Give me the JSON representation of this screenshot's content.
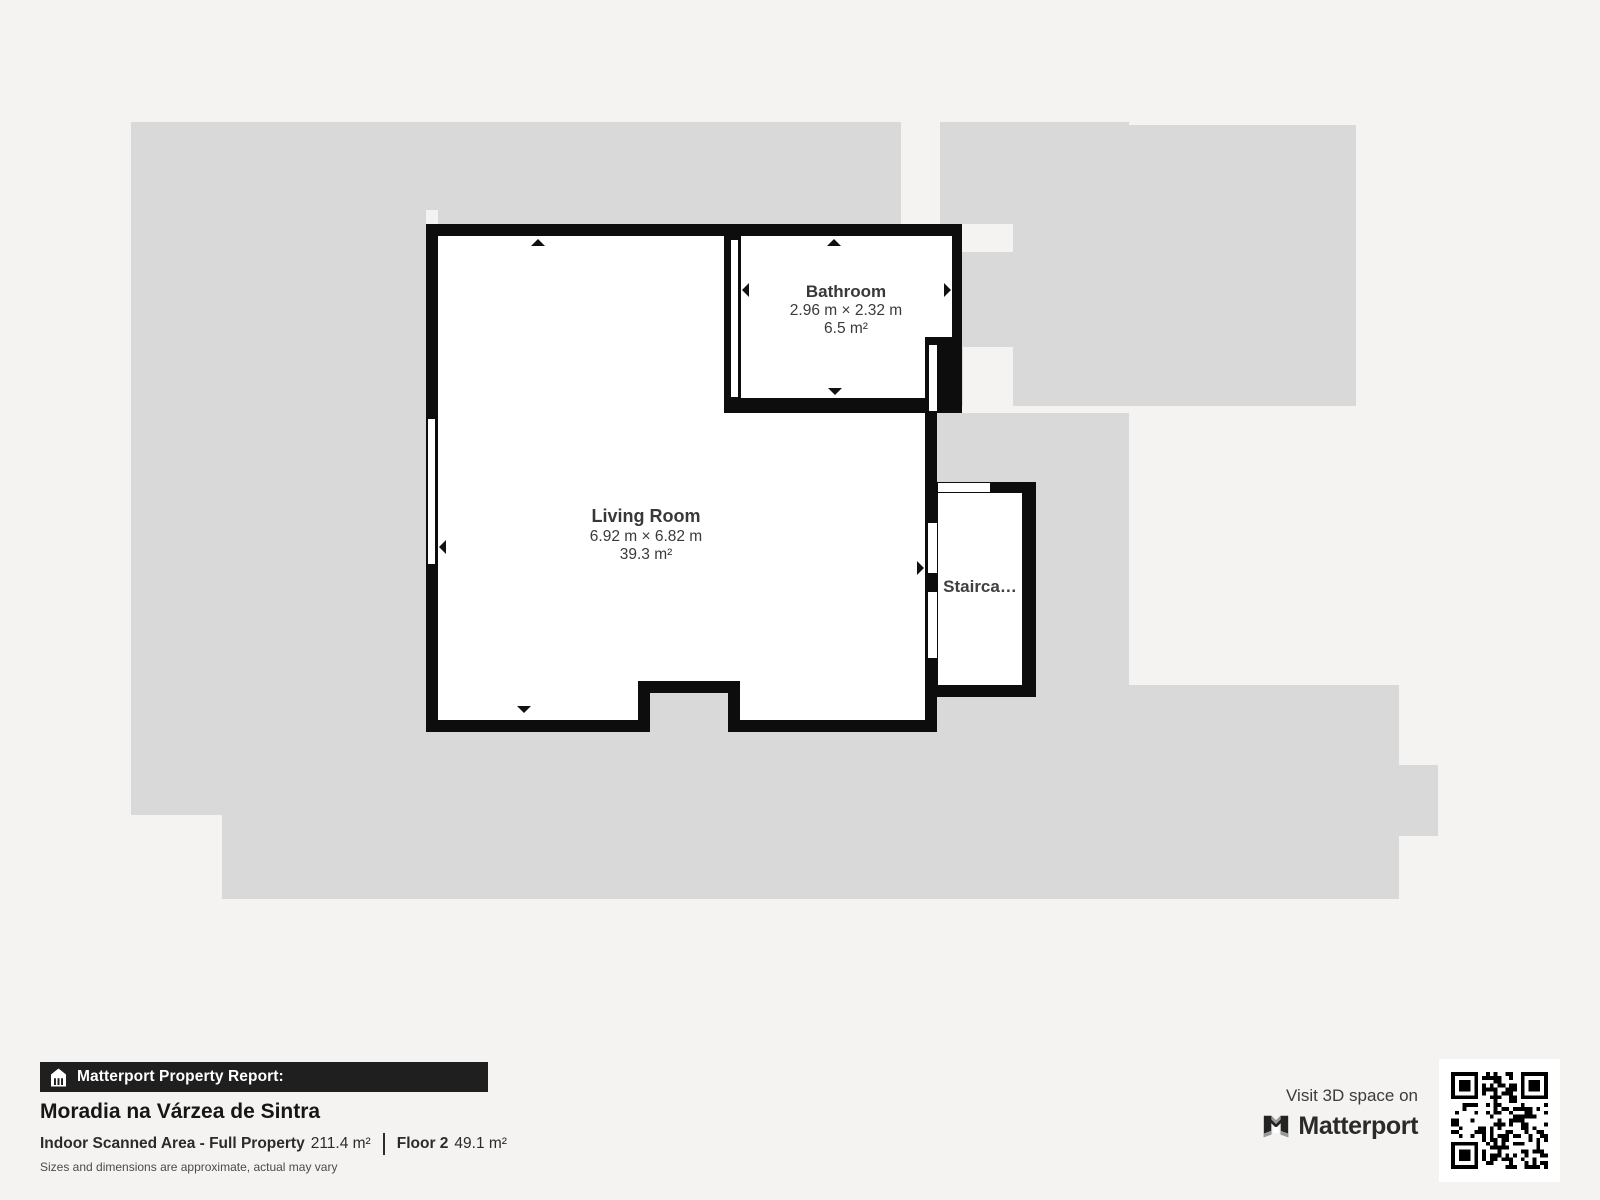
{
  "plan": {
    "floor_name": "Floor 2",
    "rooms": [
      {
        "name": "Living Room",
        "dimensions": "6.92 m × 6.82 m",
        "area": "39.3 m²"
      },
      {
        "name": "Bathroom",
        "dimensions": "2.96 m × 2.32 m",
        "area": "6.5 m²"
      },
      {
        "name": "Stairca…"
      }
    ]
  },
  "footer": {
    "report_label": "Matterport Property Report:",
    "property_name": "Moradia na Várzea de Sintra",
    "scanned_area_label": "Indoor Scanned Area - Full Property",
    "scanned_area_value": "211.4 m²",
    "floor_label": "Floor 2",
    "floor_value": "49.1 m²",
    "disclaimer": "Sizes and dimensions are approximate, actual may vary"
  },
  "cta": {
    "visit_text": "Visit 3D space on",
    "brand": "Matterport"
  },
  "colors": {
    "background": "#f4f3f1",
    "underlay_gray": "#d9d9d9",
    "wall_black": "#0d0d0d",
    "banner_black": "#1f1f1f",
    "label_gray": "#3a3a3a"
  }
}
